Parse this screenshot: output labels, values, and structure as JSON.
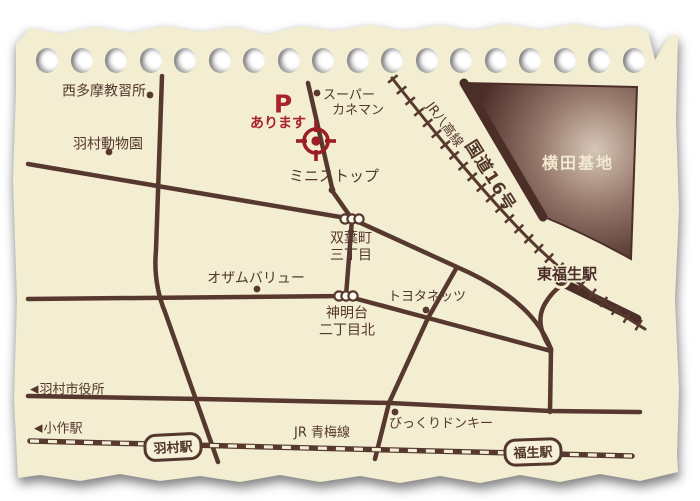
{
  "map": {
    "labels": {
      "nishitama": "西多摩教習所",
      "zoo": "羽村動物園",
      "p": "P",
      "p_sub": "あります",
      "kaneman1": "スーパー",
      "kaneman2": "カネマン",
      "ministop": "ミニストップ",
      "futaba1": "双葉町",
      "futaba2": "三丁目",
      "hachiko": "JR八高線",
      "route16": "国道16号",
      "yokota": "横田基地",
      "ozam": "オザムバリュー",
      "toyota": "トヨタネッツ",
      "higashi_fussa": "東福生駅",
      "shinmeidai1": "神明台",
      "shinmeidai2": "二丁目北",
      "cityhall": "羽村市役所",
      "ozaku": "小作駅",
      "hamura_station": "羽村駅",
      "ome": "JR 青梅線",
      "bikkuri": "びっくりドンキー",
      "fussa_station": "福生駅",
      "arrow_left": "◀"
    },
    "colors": {
      "paper": "#f3edd2",
      "ink": "#56382f",
      "red": "#a8232a",
      "base_dark": "#4c2e29",
      "cream": "#f2ead0"
    }
  }
}
